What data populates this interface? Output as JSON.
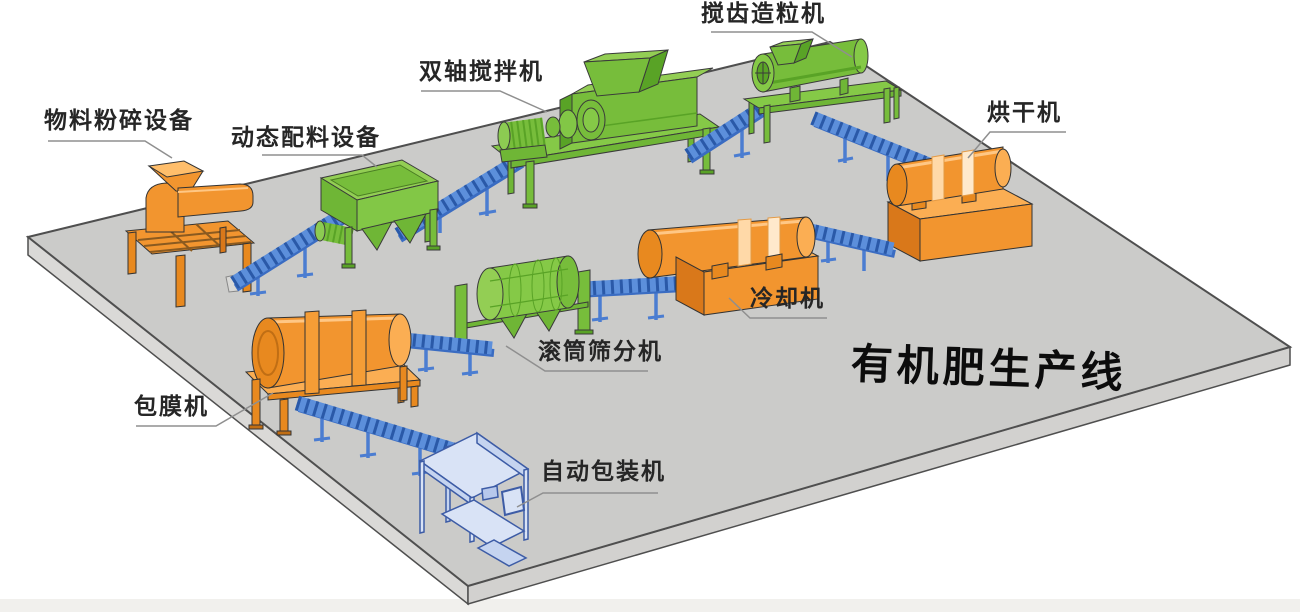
{
  "diagram": {
    "title": "有机肥生产线",
    "machines": [
      {
        "id": "crusher",
        "label": "物料粉碎设备"
      },
      {
        "id": "batcher",
        "label": "动态配料设备"
      },
      {
        "id": "mixer",
        "label": "双轴搅拌机"
      },
      {
        "id": "granulator",
        "label": "搅齿造粒机"
      },
      {
        "id": "dryer",
        "label": "烘干机"
      },
      {
        "id": "cooler",
        "label": "冷却机"
      },
      {
        "id": "screener",
        "label": "滚筒筛分机"
      },
      {
        "id": "coater",
        "label": "包膜机"
      },
      {
        "id": "packer",
        "label": "自动包装机"
      }
    ],
    "colors": {
      "machine_green": "#77BD3B",
      "machine_orange": "#F2952F",
      "conveyor_blue": "#5C8FDB",
      "packer_pale_blue": "#D9E3F6",
      "platform_gray": "#CBCBC9",
      "label_text": "#262626",
      "leader_line": "#8F8F8F"
    }
  }
}
